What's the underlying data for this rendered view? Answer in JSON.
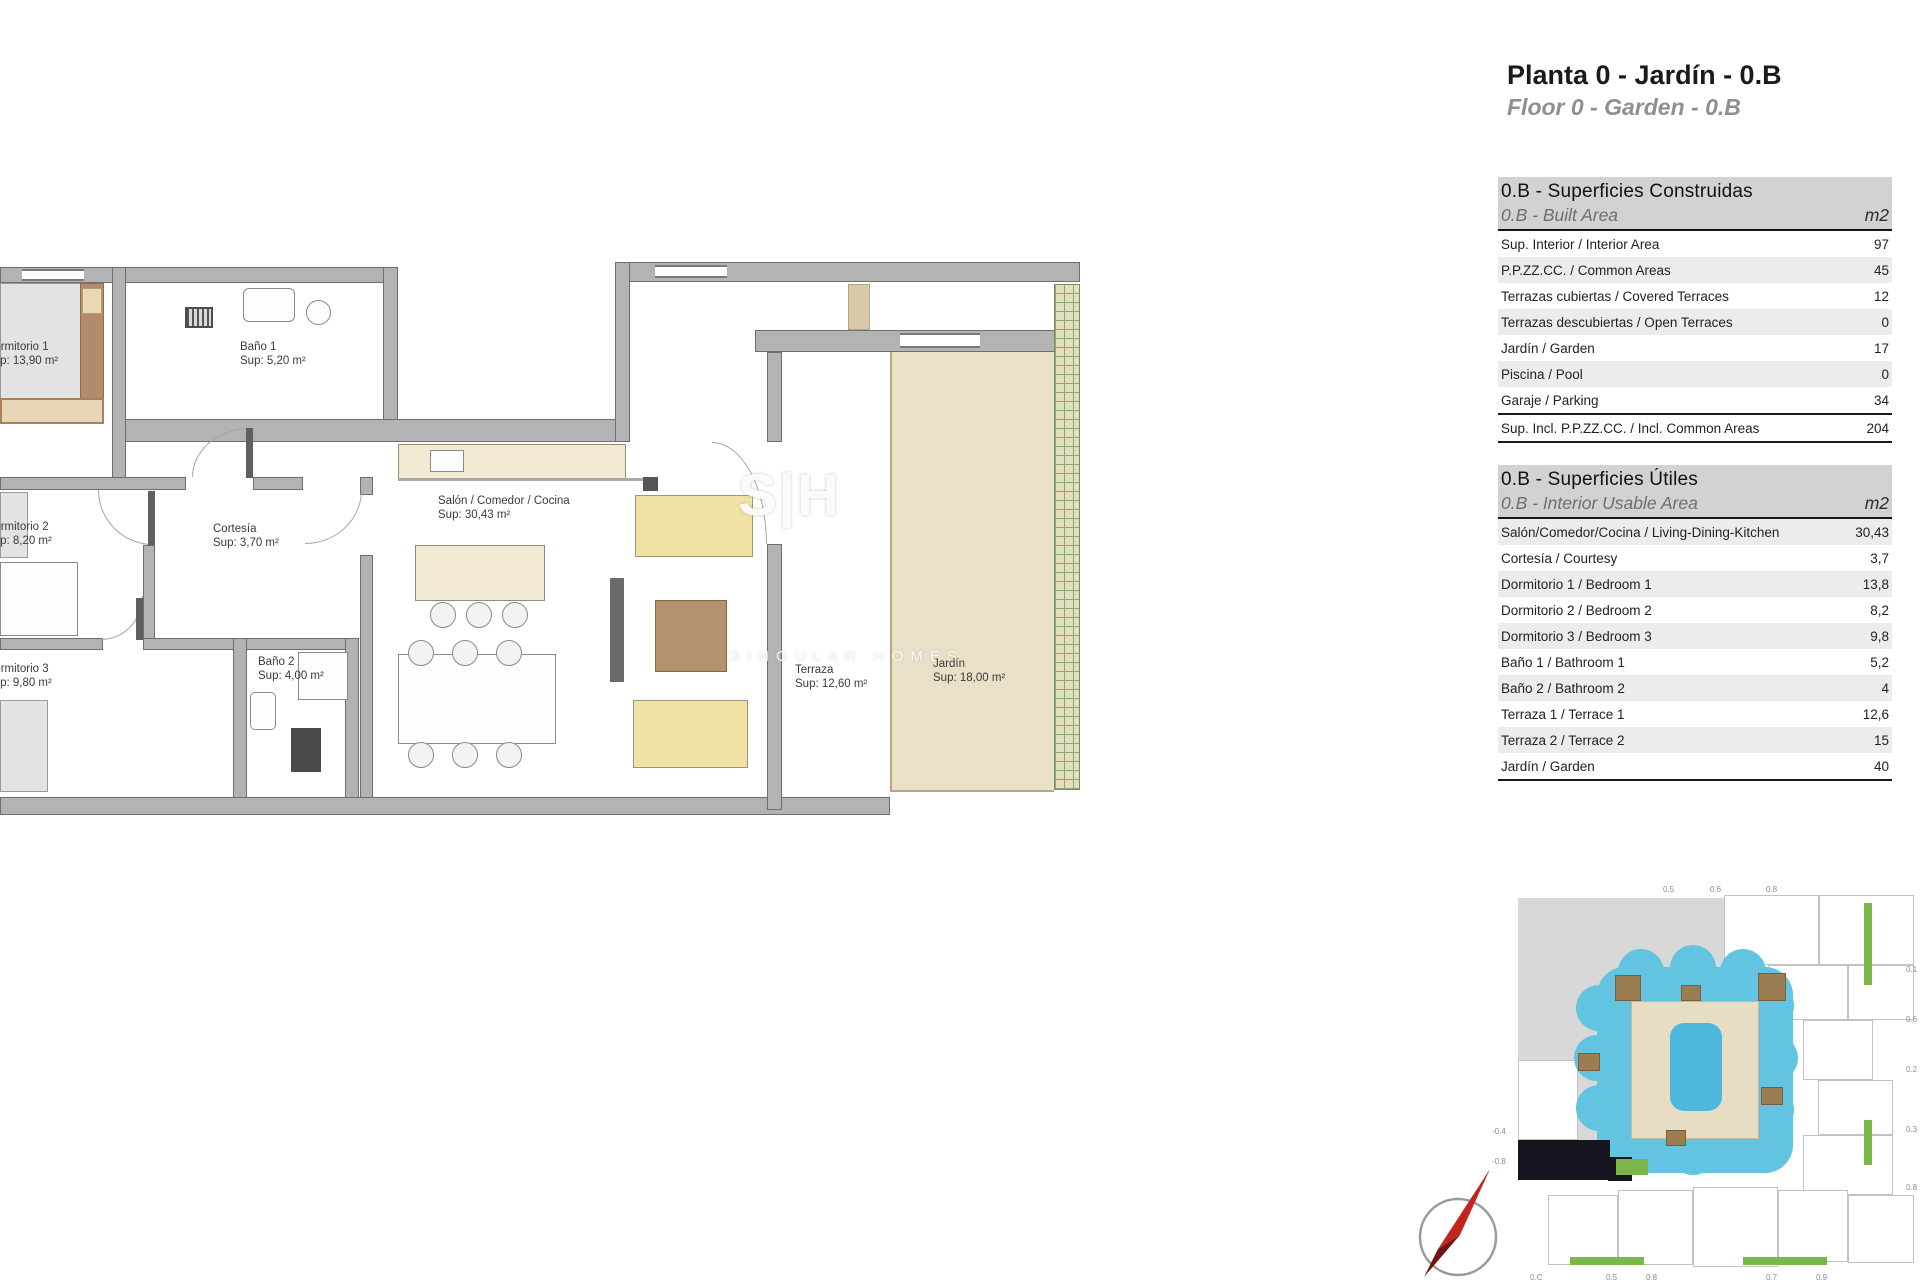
{
  "header": {
    "title": "Planta 0 - Jardín - 0.B",
    "subtitle": "Floor 0 - Garden - 0.B"
  },
  "tables": {
    "built": {
      "title_es": "0.B - Superficies Construidas",
      "title_en": "0.B - Built Area",
      "unit": "m2",
      "rows": [
        {
          "label": "Sup. Interior / Interior Area",
          "value": "97"
        },
        {
          "label": "P.P.ZZ.CC. / Common Areas",
          "value": "45"
        },
        {
          "label": "Terrazas cubiertas / Covered Terraces",
          "value": "12"
        },
        {
          "label": "Terrazas descubiertas / Open Terraces",
          "value": "0"
        },
        {
          "label": "Jardín / Garden",
          "value": "17"
        },
        {
          "label": "Piscina / Pool",
          "value": "0"
        },
        {
          "label": "Garaje / Parking",
          "value": "34"
        },
        {
          "label": "Sup. Incl. P.P.ZZ.CC. / Incl. Common Areas",
          "value": "204"
        }
      ]
    },
    "usable": {
      "title_es": "0.B - Superficies Útiles",
      "title_en": "0.B - Interior Usable Area",
      "unit": "m2",
      "rows": [
        {
          "label": "Salón/Comedor/Cocina / Living-Dining-Kitchen",
          "value": "30,43"
        },
        {
          "label": "Cortesía / Courtesy",
          "value": "3,7"
        },
        {
          "label": "Dormitorio 1 / Bedroom 1",
          "value": "13,8"
        },
        {
          "label": "Dormitorio 2 / Bedroom 2",
          "value": "8,2"
        },
        {
          "label": "Dormitorio 3 / Bedroom 3",
          "value": "9,8"
        },
        {
          "label": "Baño 1 / Bathroom 1",
          "value": "5,2"
        },
        {
          "label": "Baño 2 / Bathroom 2",
          "value": "4"
        },
        {
          "label": "Terraza 1 / Terrace 1",
          "value": "12,6"
        },
        {
          "label": "Terraza 2 / Terrace 2",
          "value": "15"
        },
        {
          "label": "Jardín / Garden",
          "value": "40"
        }
      ]
    }
  },
  "plan": {
    "rooms": {
      "dormitorio1": {
        "name": "Dormitorio 1",
        "area": "Sup: 13,90 m²"
      },
      "banio1": {
        "name": "Baño 1",
        "area": "Sup: 5,20 m²"
      },
      "dormitorio2": {
        "name": "Dormitorio 2",
        "area": "Sup: 8,20 m²"
      },
      "cortesia": {
        "name": "Cortesía",
        "area": "Sup: 3,70 m²"
      },
      "salon": {
        "name": "Salón / Comedor / Cocina",
        "area": "Sup: 30,43 m²"
      },
      "dormitorio3": {
        "name": "Dormitorio 3",
        "area": "Sup: 9,80 m²"
      },
      "banio2": {
        "name": "Baño 2",
        "area": "Sup: 4,00 m²"
      },
      "terraza": {
        "name": "Terraza",
        "area": "Sup: 12,60 m²"
      },
      "jardin": {
        "name": "Jardín",
        "area": "Sup: 18,00 m²"
      }
    },
    "watermark": {
      "logo": "S|H",
      "text": "SINGULAR HOMES"
    }
  },
  "siteplan": {
    "labels_top": [
      "0.5",
      "0.6",
      "0.8"
    ],
    "labels_right": [
      "0.1",
      "0.6",
      "0.2",
      "0.3",
      "0.8"
    ],
    "labels_left": [
      "-0.4",
      "-0.8"
    ],
    "labels_bottom": [
      "0.C",
      "0.5",
      "0.8",
      "0.7",
      "0.9"
    ]
  },
  "colors": {
    "wall_gray": "#b3b3b3",
    "counter_tan": "#f2e9d3",
    "garden_tan": "#e9e0c8",
    "sofa_yellow": "#f1e2a4",
    "pool_blue": "#62c4e0",
    "unit_highlight_black": "#15151f",
    "landscape_green": "#7ab648",
    "compass_red": "#c0251f"
  }
}
